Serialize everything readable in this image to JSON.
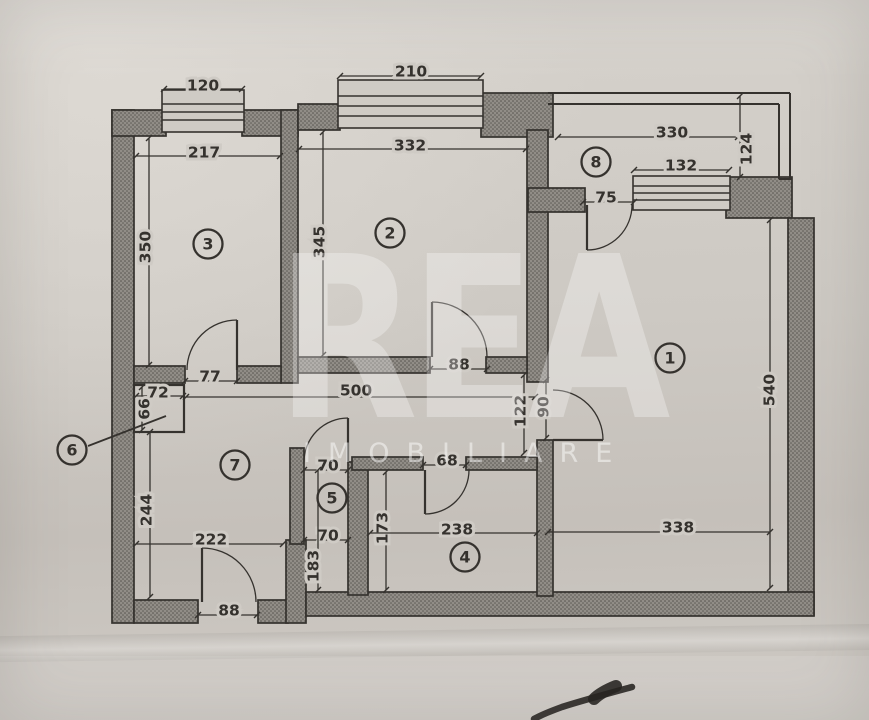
{
  "watermark": {
    "title": "REA",
    "subtitle": "IMOBILIARE"
  },
  "colors": {
    "paper": "#cfcbc5",
    "ink": "#35322e",
    "wall_base": "#918d87",
    "wall_dot": "#514e49",
    "pen": "#24221f"
  },
  "floorplan": {
    "rooms": [
      {
        "label": "1",
        "x": 670,
        "y": 358
      },
      {
        "label": "2",
        "x": 390,
        "y": 233
      },
      {
        "label": "3",
        "x": 208,
        "y": 244
      },
      {
        "label": "4",
        "x": 465,
        "y": 557
      },
      {
        "label": "5",
        "x": 332,
        "y": 498
      },
      {
        "label": "6",
        "x": 72,
        "y": 450
      },
      {
        "label": "7",
        "x": 235,
        "y": 465
      },
      {
        "label": "8",
        "x": 596,
        "y": 162
      }
    ],
    "walls": [
      [
        112,
        110,
        22,
        513
      ],
      [
        112,
        110,
        54,
        26
      ],
      [
        242,
        110,
        56,
        26
      ],
      [
        281,
        110,
        17,
        273
      ],
      [
        298,
        104,
        42,
        26
      ],
      [
        481,
        93,
        72,
        44
      ],
      [
        527,
        130,
        21,
        252
      ],
      [
        528,
        188,
        57,
        24
      ],
      [
        726,
        177,
        66,
        41
      ],
      [
        788,
        218,
        26,
        397
      ],
      [
        134,
        600,
        64,
        23
      ],
      [
        258,
        600,
        30,
        23
      ],
      [
        286,
        540,
        20,
        83
      ],
      [
        306,
        592,
        508,
        24
      ],
      [
        134,
        366,
        51,
        17
      ],
      [
        237,
        366,
        44,
        17
      ],
      [
        298,
        357,
        132,
        16
      ],
      [
        486,
        357,
        41,
        16
      ],
      [
        537,
        440,
        16,
        156
      ],
      [
        290,
        448,
        14,
        96
      ],
      [
        348,
        462,
        20,
        133
      ],
      [
        352,
        457,
        71,
        13
      ],
      [
        466,
        457,
        71,
        13
      ]
    ],
    "boxes": [
      {
        "x": 134,
        "y": 385,
        "w": 50,
        "h": 47
      }
    ],
    "windows": [
      {
        "x": 162,
        "y": 90,
        "w": 82,
        "h": 42,
        "bars": [
          104,
          112,
          120
        ]
      },
      {
        "x": 338,
        "y": 80,
        "w": 145,
        "h": 48,
        "bars": [
          96,
          106,
          116
        ]
      },
      {
        "x": 633,
        "y": 176,
        "w": 97,
        "h": 34,
        "bars": [
          186,
          193,
          200
        ]
      }
    ],
    "parapet": [
      [
        548,
        93,
        790,
        93
      ],
      [
        548,
        104,
        779,
        104
      ],
      [
        790,
        93,
        790,
        179
      ],
      [
        779,
        104,
        779,
        179
      ],
      [
        779,
        179,
        792,
        179
      ]
    ],
    "doors": [
      {
        "hinge": [
          237,
          370
        ],
        "leaf": [
          237,
          320
        ],
        "jamb": [
          187,
          370
        ]
      },
      {
        "hinge": [
          432,
          357
        ],
        "leaf": [
          432,
          302
        ],
        "jamb": [
          487,
          357
        ]
      },
      {
        "hinge": [
          587,
          205
        ],
        "leaf": [
          587,
          250
        ],
        "jamb": [
          632,
          205
        ]
      },
      {
        "hinge": [
          553,
          440
        ],
        "leaf": [
          603,
          440
        ],
        "jamb": [
          553,
          390
        ]
      },
      {
        "hinge": [
          348,
          462
        ],
        "leaf": [
          348,
          418
        ],
        "jamb": [
          304,
          462
        ]
      },
      {
        "hinge": [
          425,
          470
        ],
        "leaf": [
          425,
          514
        ],
        "jamb": [
          469,
          470
        ]
      },
      {
        "hinge": [
          202,
          602
        ],
        "leaf": [
          202,
          548
        ],
        "jamb": [
          256,
          602
        ]
      }
    ],
    "dimensions": [
      {
        "label": "120",
        "x": 203,
        "y": 86,
        "vertical": false,
        "line": [
          164,
          89,
          242,
          89
        ]
      },
      {
        "label": "217",
        "x": 204,
        "y": 153,
        "vertical": false,
        "line": [
          136,
          156,
          280,
          156
        ]
      },
      {
        "label": "350",
        "x": 146,
        "y": 247,
        "vertical": true,
        "line": [
          149,
          138,
          149,
          365
        ]
      },
      {
        "label": "210",
        "x": 411,
        "y": 72,
        "vertical": false,
        "line": [
          340,
          76,
          481,
          76
        ]
      },
      {
        "label": "332",
        "x": 410,
        "y": 146,
        "vertical": false,
        "line": [
          299,
          149,
          526,
          149
        ]
      },
      {
        "label": "345",
        "x": 320,
        "y": 242,
        "vertical": true,
        "line": [
          323,
          132,
          323,
          355
        ]
      },
      {
        "label": "330",
        "x": 672,
        "y": 133,
        "vertical": false,
        "line": [
          558,
          137,
          738,
          137
        ]
      },
      {
        "label": "124",
        "x": 747,
        "y": 149,
        "vertical": true,
        "line": [
          740,
          96,
          740,
          177
        ]
      },
      {
        "label": "132",
        "x": 681,
        "y": 166,
        "vertical": false,
        "line": [
          634,
          170,
          729,
          170
        ]
      },
      {
        "label": "75",
        "x": 606,
        "y": 198,
        "vertical": false,
        "line": [
          583,
          202,
          634,
          202
        ]
      },
      {
        "label": "540",
        "x": 770,
        "y": 390,
        "vertical": true,
        "line": [
          770,
          220,
          770,
          588
        ]
      },
      {
        "label": "77",
        "x": 210,
        "y": 377,
        "vertical": false,
        "line": [
          185,
          381,
          237,
          381
        ]
      },
      {
        "label": "88",
        "x": 459,
        "y": 365,
        "vertical": false,
        "line": [
          430,
          369,
          487,
          369
        ]
      },
      {
        "label": "500",
        "x": 356,
        "y": 391,
        "vertical": false,
        "line": [
          186,
          397,
          535,
          397
        ]
      },
      {
        "label": "122",
        "x": 521,
        "y": 411,
        "vertical": true,
        "line": [
          524,
          375,
          524,
          453
        ]
      },
      {
        "label": "90",
        "x": 544,
        "y": 407,
        "vertical": true,
        "line": [
          546,
          380,
          546,
          438
        ]
      },
      {
        "label": "72",
        "x": 158,
        "y": 393,
        "vertical": false,
        "line": [
          136,
          396,
          183,
          396
        ]
      },
      {
        "label": "66",
        "x": 145,
        "y": 409,
        "vertical": true,
        "line": [
          142,
          387,
          142,
          430
        ]
      },
      {
        "label": "70",
        "x": 328,
        "y": 466,
        "vertical": false,
        "line": [
          304,
          470,
          348,
          470
        ]
      },
      {
        "label": "70",
        "x": 328,
        "y": 536,
        "vertical": false,
        "line": [
          304,
          540,
          348,
          540
        ]
      },
      {
        "label": "68",
        "x": 447,
        "y": 461,
        "vertical": false,
        "line": [
          423,
          465,
          466,
          465
        ]
      },
      {
        "label": "244",
        "x": 147,
        "y": 510,
        "vertical": true,
        "line": [
          150,
          432,
          150,
          597
        ]
      },
      {
        "label": "222",
        "x": 211,
        "y": 540,
        "vertical": false,
        "line": [
          136,
          544,
          283,
          544
        ]
      },
      {
        "label": "183",
        "x": 314,
        "y": 566,
        "vertical": true,
        "line": [
          318,
          470,
          318,
          590
        ]
      },
      {
        "label": "173",
        "x": 383,
        "y": 528,
        "vertical": true,
        "line": [
          386,
          472,
          386,
          590
        ]
      },
      {
        "label": "238",
        "x": 457,
        "y": 530,
        "vertical": false,
        "line": [
          370,
          533,
          537,
          533
        ]
      },
      {
        "label": "338",
        "x": 678,
        "y": 528,
        "vertical": false,
        "line": [
          548,
          532,
          770,
          532
        ]
      },
      {
        "label": "88",
        "x": 229,
        "y": 611,
        "vertical": false,
        "line": [
          198,
          615,
          257,
          615
        ]
      }
    ],
    "leader_line": [
      88,
      446,
      166,
      416
    ],
    "pen_marks": [
      {
        "path": "M632 687 C610 693 584 700 562 707 C551 711 541 715 534 719",
        "width": 6.5
      },
      {
        "path": "M616 686 C606 690 599 694 594 699",
        "width": 12
      }
    ]
  }
}
